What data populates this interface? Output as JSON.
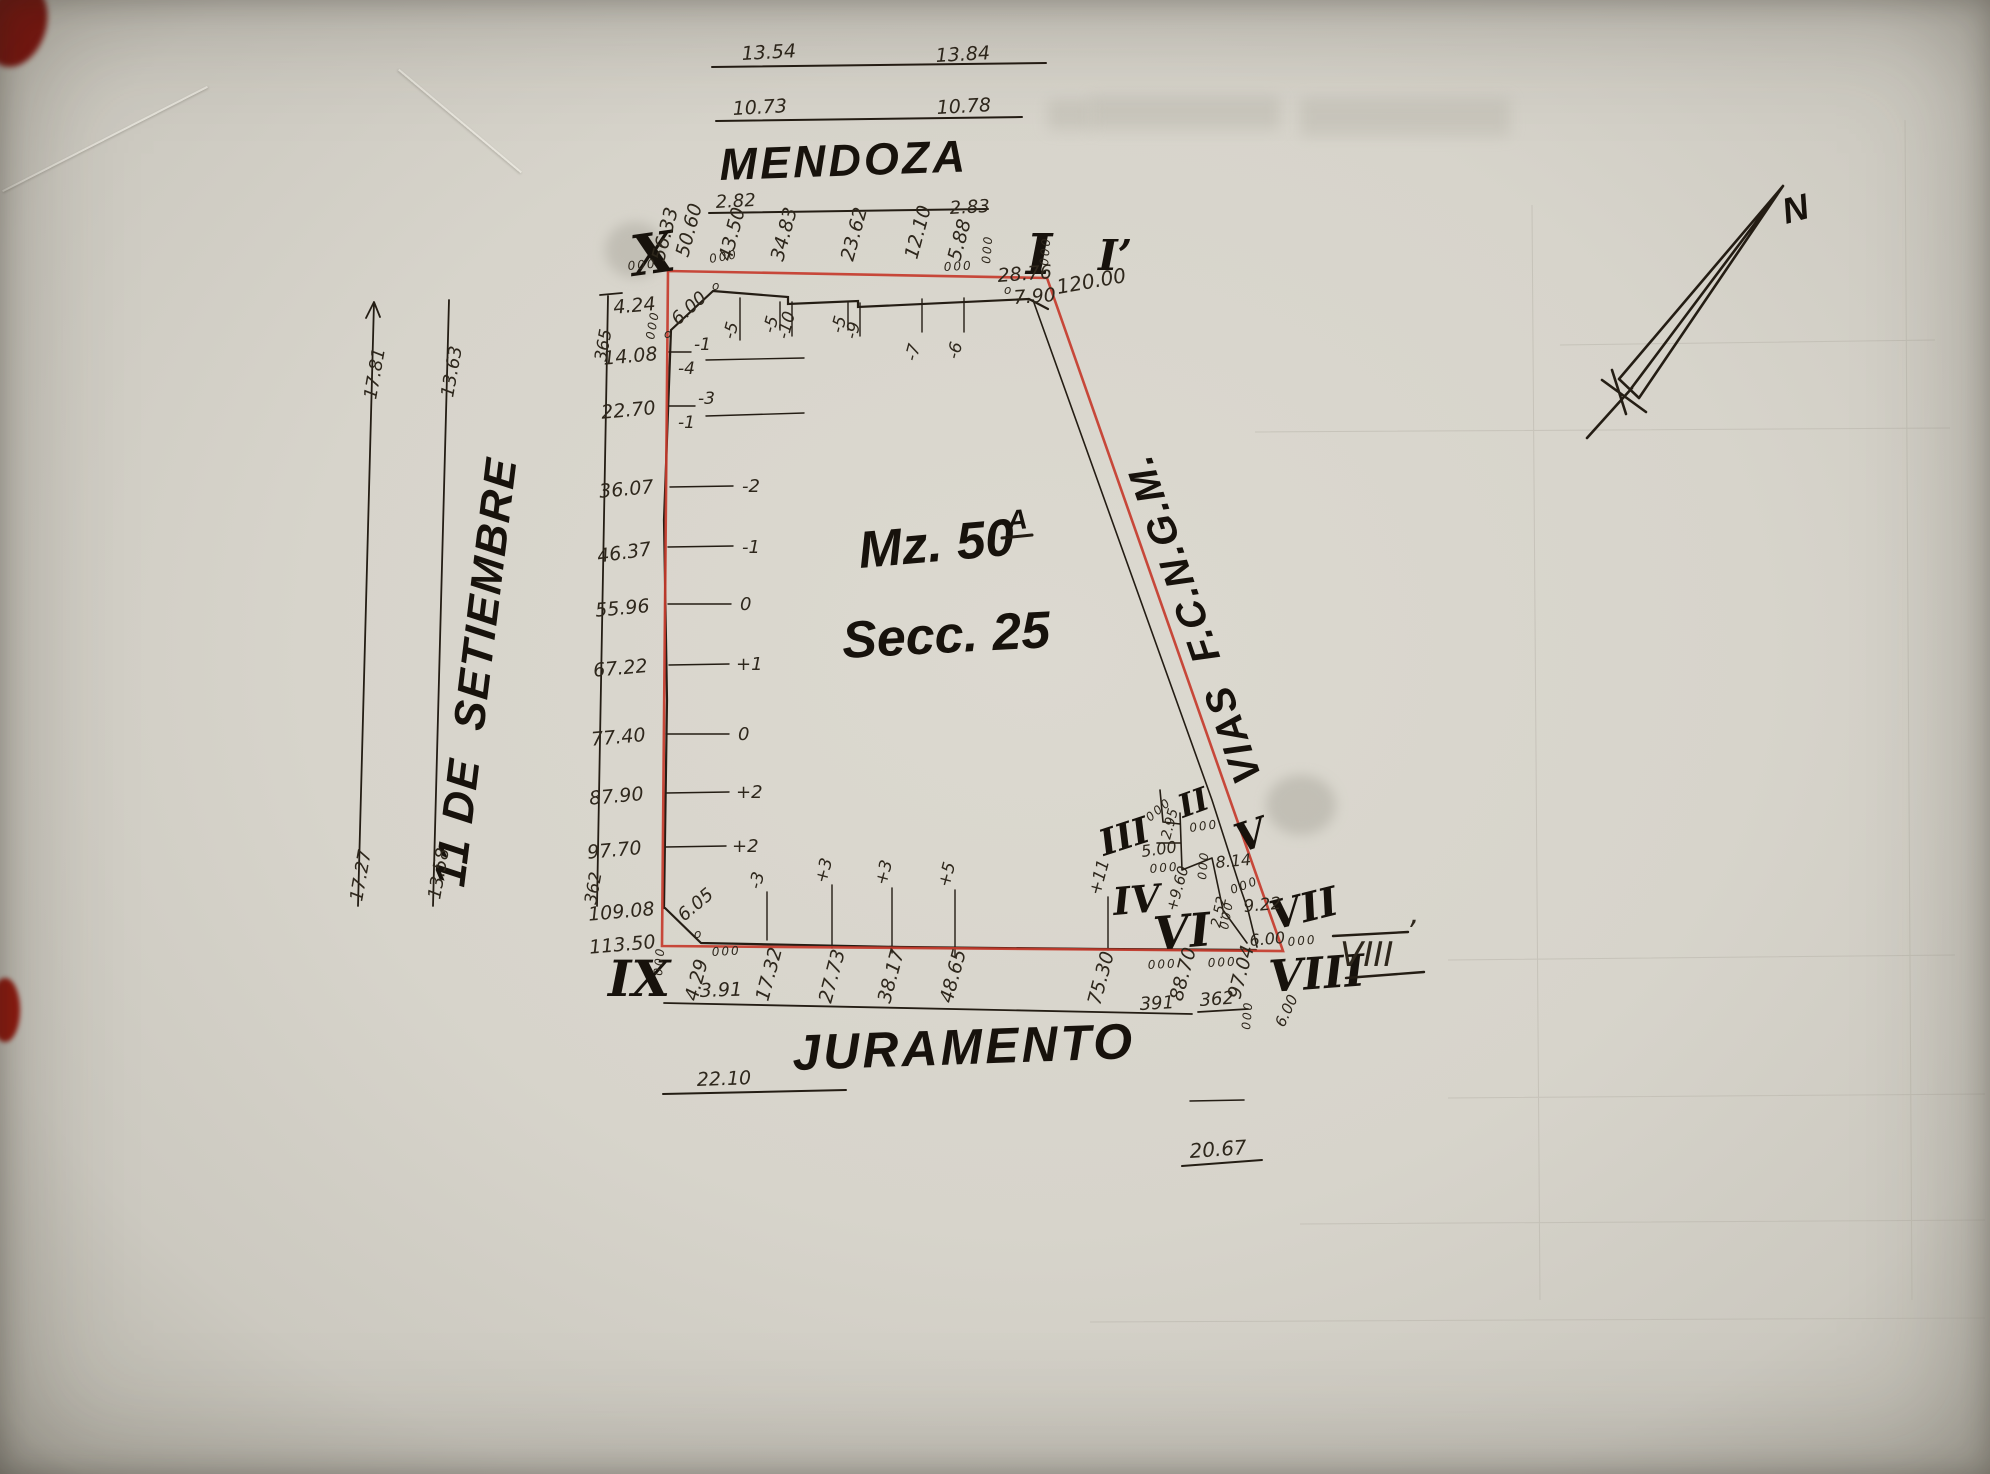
{
  "plot": {
    "block_label": "Mz. 50",
    "block_sup": "A",
    "section_label": "Secc. 25"
  },
  "streets": {
    "top": "MENDOZA",
    "bottom": "JURAMENTO",
    "left": "11 DE  SETIEMBRE",
    "railway": "VIAS  F.C.N.G.M."
  },
  "north": {
    "label": "N"
  },
  "corner_marks": {
    "tl": "X",
    "tr": "I",
    "tr_prime": "I’",
    "bl": "IX",
    "p2": "II",
    "p3": "III",
    "p4": "IV",
    "p5": "V",
    "p6": "VI",
    "p7": "VII",
    "p8": "VIII",
    "p8_prime": "VIII",
    "p8_prime_tick": "’"
  },
  "street_dims": {
    "mendoza_far_left": "13.54",
    "mendoza_far_right": "13.84",
    "mendoza_mid_left": "10.73",
    "mendoza_mid_right": "10.78",
    "mendoza_near_left": "2.82",
    "mendoza_near_right": "2.83",
    "setiembre_outer_top": "17.81",
    "setiembre_inner_top": "13.63",
    "setiembre_outer_bottom": "17.27",
    "setiembre_inner_bottom": "13.58",
    "juramento_left": "3.91",
    "juramento_mid": "22.10",
    "juramento_right": "20.67"
  },
  "left_side": {
    "stations": [
      "4.24",
      "14.08",
      "22.70",
      "36.07",
      "46.37",
      "55.96",
      "67.22",
      "77.40",
      "87.90",
      "97.70",
      "109.08",
      "113.50"
    ],
    "offsets": [
      "-1",
      "-4",
      "-3",
      "-1",
      "-2",
      "-1",
      "0",
      "+1",
      "0",
      "+2",
      "+2"
    ],
    "ref_top": "365",
    "ref_bottom": "362"
  },
  "top_side": {
    "stations": [
      "56.33",
      "50.60",
      "43.50",
      "34.83",
      "23.62",
      "12.10",
      "5.88"
    ],
    "offsets": [
      "-5",
      "-5",
      "-10",
      "-5",
      "-9",
      "-7",
      "-6"
    ]
  },
  "bottom_side": {
    "stations": [
      "4.29",
      "17.32",
      "27.73",
      "38.17",
      "48.65",
      "75.30",
      "88.70",
      "97.04"
    ],
    "offsets": [
      "-3",
      "+3",
      "+3",
      "+5",
      "+11"
    ],
    "ref_a": "391",
    "ref_b": "362"
  },
  "corner_dims": {
    "tl_bevel": "6.00",
    "bl_bevel": "6.05",
    "tr_offset": "28.76",
    "tr_drop": "7.90",
    "tr_length": "120.00"
  },
  "cluster_dims": {
    "seg_a": "5.00",
    "seg_b": "2.95",
    "seg_c": "8.14",
    "seg_d": "9.22",
    "seg_e": "2.52",
    "seg_f": "+9.60",
    "seg_g": "6.00",
    "seg_h": "6.00"
  },
  "survey_mark": "000",
  "survey_mark_single": "o",
  "colors": {
    "ink": "#241d14",
    "red_line": "#c63b2c",
    "paper": "#d7d4cb"
  }
}
